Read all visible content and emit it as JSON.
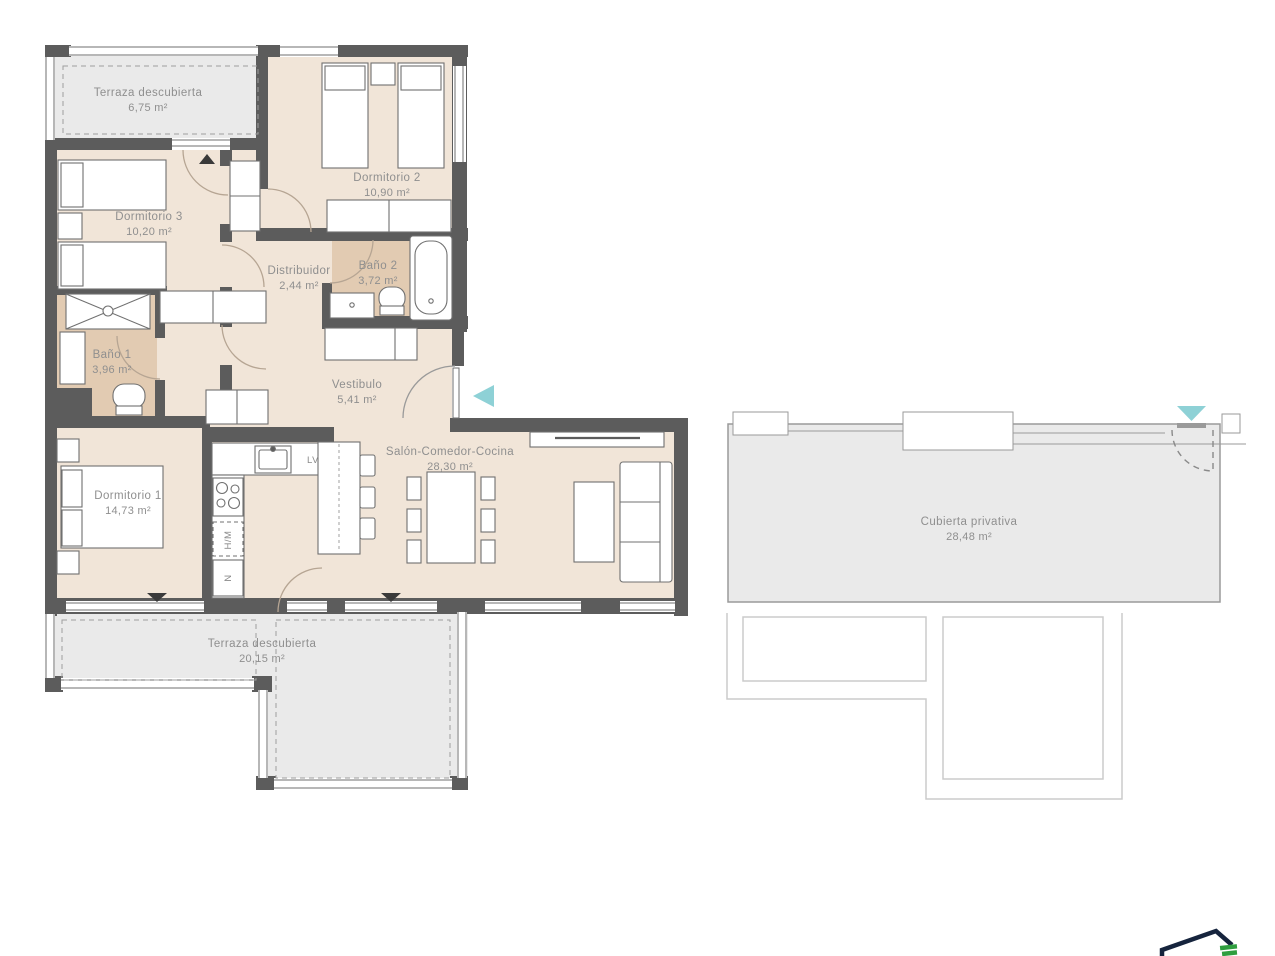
{
  "document": {
    "type": "residential floor plan",
    "background": "#ffffff"
  },
  "colors": {
    "wall": "#5c5c5c",
    "interior_floor": "#f1e5d8",
    "bathroom_floor": "#e2cbb2",
    "terrace_floor": "#eaeaea",
    "entrance_arrow_teal": "#8ed1d6",
    "door_arc": "#b6a593",
    "ghost_outline": "#cbcbcb",
    "label_text": "#8f8f8f",
    "logo_navy": "#16243d",
    "logo_green": "#2f9e3f"
  },
  "rooms": [
    {
      "name": "Terraza descubierta",
      "area": "6,75 m²"
    },
    {
      "name": "Dormitorio 2",
      "area": "10,90 m²"
    },
    {
      "name": "Dormitorio 3",
      "area": "10,20 m²"
    },
    {
      "name": "Distribuidor",
      "area": "2,44 m²"
    },
    {
      "name": "Baño 2",
      "area": "3,72 m²"
    },
    {
      "name": "Baño 1",
      "area": "3,96 m²"
    },
    {
      "name": "Vestibulo",
      "area": "5,41 m²"
    },
    {
      "name": "Dormitorio 1",
      "area": "14,73 m²"
    },
    {
      "name": "Salón-Comedor-Cocina",
      "area": "28,30 m²"
    },
    {
      "name": "Terraza descubierta",
      "area": "20,15 m²"
    },
    {
      "name": "Cubierta privativa",
      "area": "28,48 m²"
    }
  ],
  "kitchen_labels": {
    "dishwasher": "LV",
    "oven_microwave": "H/M",
    "fridge": "N"
  }
}
